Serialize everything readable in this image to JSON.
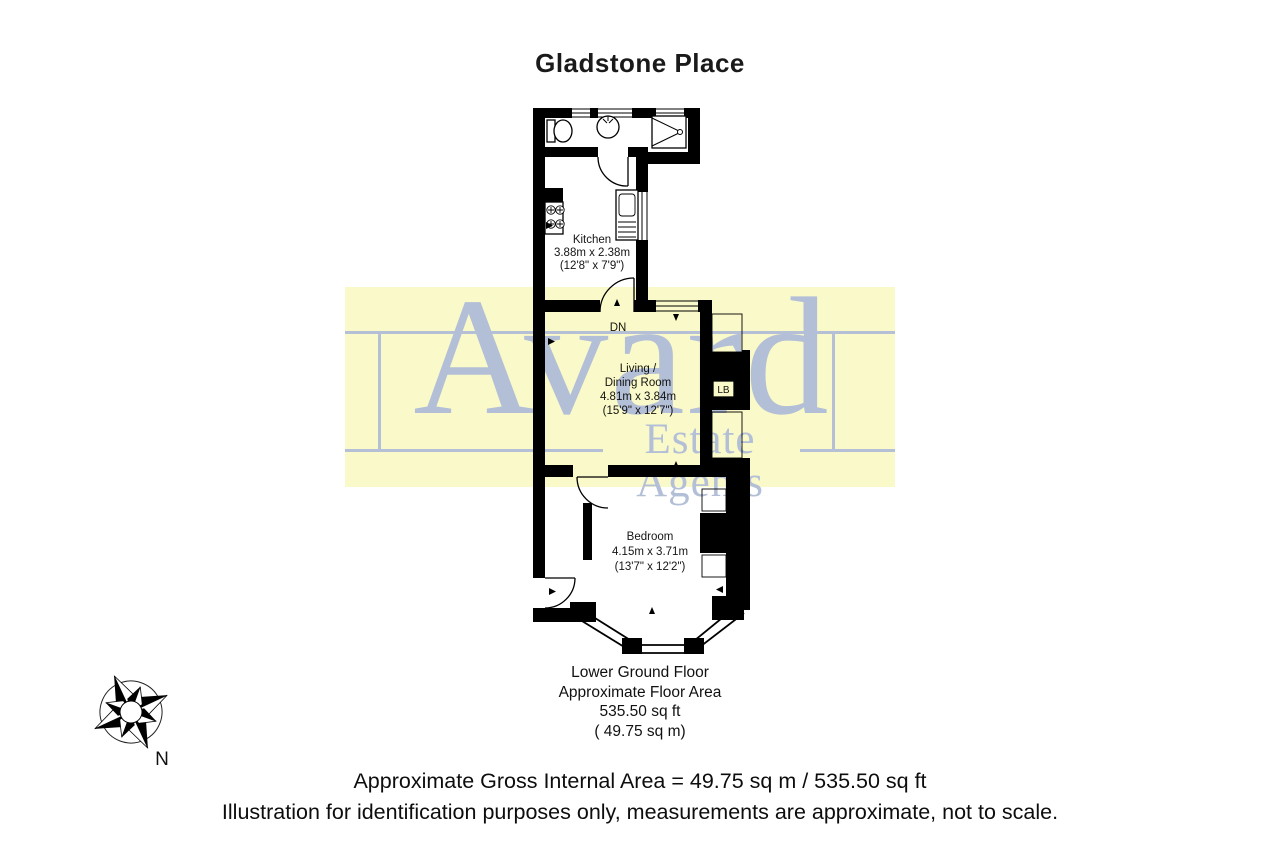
{
  "page": {
    "title": "Gladstone Place"
  },
  "watermark": {
    "name": "Avard",
    "tagline": "Estate Agents"
  },
  "colors": {
    "accent_blue": "#B3BFD6",
    "band_yellow": "#FAF9C9",
    "wall": "#000000",
    "text": "#111111"
  },
  "rooms": {
    "kitchen": {
      "name": "Kitchen",
      "dims_m": "3.88m x 2.38m",
      "dims_ft": "(12'8\" x 7'9\")"
    },
    "living": {
      "name_line1": "Living /",
      "name_line2": "Dining Room",
      "dims_m": "4.81m x 3.84m",
      "dims_ft": "(15'9\" x 12'7\")"
    },
    "bedroom": {
      "name": "Bedroom",
      "dims_m": "4.15m x 3.71m",
      "dims_ft": "(13'7\" x 12'2\")"
    }
  },
  "plan_labels": {
    "dn": "DN",
    "lb": "LB"
  },
  "compass": {
    "label": "N"
  },
  "floor_summary": {
    "lines": [
      "Lower Ground Floor",
      "Approximate Floor Area",
      "535.50 sq ft",
      "( 49.75 sq m)"
    ]
  },
  "footer": {
    "line1": "Approximate Gross Internal Area = 49.75 sq m / 535.50 sq ft",
    "line2": "Illustration for identification purposes only, measurements are approximate, not to scale."
  }
}
